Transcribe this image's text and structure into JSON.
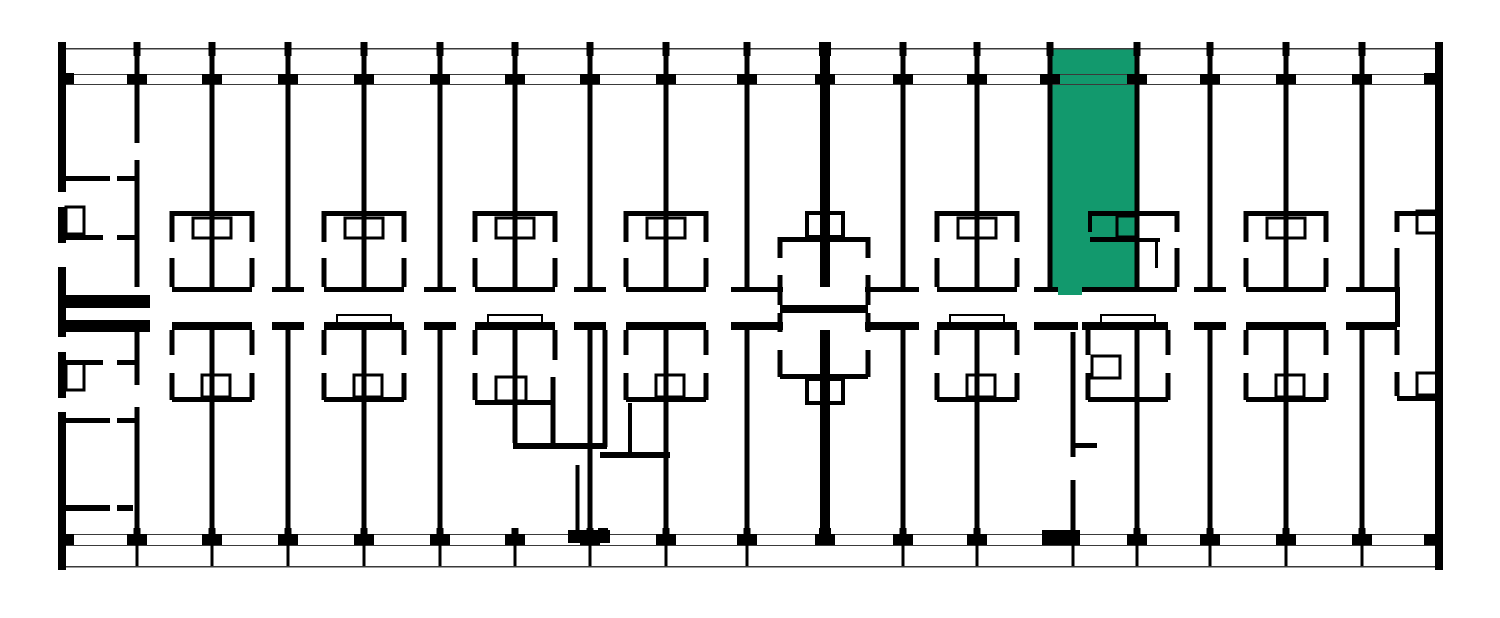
{
  "meta": {
    "view": "building-floor-plan",
    "canvas": {
      "width": 1500,
      "height": 618
    },
    "background": "#ffffff",
    "wall_color": "#000000",
    "thin_line_color": "#3a3a3a",
    "highlight_color": "#12996D"
  },
  "selected_unit": {
    "rects": [
      [
        1050,
        48,
        87,
        240
      ],
      [
        1058,
        286,
        24,
        9
      ]
    ]
  },
  "thin_lines": [
    [
      58,
      48,
      1385,
      1.6
    ],
    [
      58,
      74,
      1385,
      1.2
    ],
    [
      58,
      84,
      1385,
      1.2
    ],
    [
      58,
      534,
      1385,
      1.2
    ],
    [
      58,
      545,
      1385,
      1.2
    ],
    [
      58,
      566,
      1385,
      1.6
    ]
  ],
  "walls": [
    [
      58,
      42,
      8,
      528
    ],
    [
      1435,
      42,
      8,
      528
    ],
    [
      134.5,
      49,
      5,
      94
    ],
    [
      134.5,
      160,
      5,
      127
    ],
    [
      209.5,
      49,
      5,
      238
    ],
    [
      285.5,
      49,
      5,
      238
    ],
    [
      361.5,
      49,
      5,
      238
    ],
    [
      437.5,
      49,
      5,
      238
    ],
    [
      512.5,
      49,
      5,
      238
    ],
    [
      587.5,
      49,
      5,
      238
    ],
    [
      663.5,
      49,
      5,
      238
    ],
    [
      744.5,
      49,
      5,
      238
    ],
    [
      820,
      49,
      10,
      238
    ],
    [
      900.5,
      49,
      5,
      238
    ],
    [
      974.5,
      49,
      5,
      238
    ],
    [
      1047.5,
      49,
      5,
      238
    ],
    [
      1134.5,
      49,
      5,
      238
    ],
    [
      1207.5,
      49,
      5,
      238
    ],
    [
      1283.5,
      49,
      5,
      238
    ],
    [
      1359.5,
      49,
      5,
      238
    ],
    [
      134.5,
      330,
      5,
      55
    ],
    [
      134.5,
      407,
      5,
      138
    ],
    [
      209.5,
      330,
      5,
      215
    ],
    [
      285.5,
      330,
      5,
      215
    ],
    [
      361.5,
      330,
      5,
      215
    ],
    [
      437.5,
      330,
      5,
      215
    ],
    [
      512.5,
      330,
      5,
      113
    ],
    [
      587.5,
      330,
      5,
      215
    ],
    [
      663.5,
      330,
      5,
      215
    ],
    [
      744.5,
      330,
      5,
      215
    ],
    [
      820,
      330,
      10,
      215
    ],
    [
      900.5,
      330,
      5,
      215
    ],
    [
      974.5,
      330,
      5,
      215
    ],
    [
      1070.5,
      332,
      5,
      125
    ],
    [
      1070.5,
      480,
      5,
      55
    ],
    [
      1134.5,
      330,
      5,
      215
    ],
    [
      1207.5,
      330,
      5,
      215
    ],
    [
      1283.5,
      330,
      5,
      215
    ],
    [
      1359.5,
      330,
      5,
      215
    ],
    [
      58,
      295,
      92,
      13
    ],
    [
      172,
      287,
      80,
      5
    ],
    [
      272,
      287,
      32,
      5
    ],
    [
      324,
      287,
      80,
      5
    ],
    [
      424,
      287,
      32,
      5
    ],
    [
      475,
      287,
      80,
      5
    ],
    [
      574,
      287,
      32,
      5
    ],
    [
      626,
      287,
      80,
      5
    ],
    [
      731,
      287,
      52,
      5
    ],
    [
      865,
      287,
      54,
      5
    ],
    [
      937,
      287,
      80,
      5
    ],
    [
      1034,
      287,
      24,
      5
    ],
    [
      1082,
      287,
      95,
      5
    ],
    [
      1194,
      287,
      32,
      5
    ],
    [
      1246,
      287,
      80,
      5
    ],
    [
      1346,
      287,
      51,
      5
    ],
    [
      58,
      320,
      92,
      12
    ],
    [
      172,
      322,
      80,
      8
    ],
    [
      272,
      322,
      32,
      8
    ],
    [
      324,
      322,
      80,
      8
    ],
    [
      424,
      322,
      32,
      8
    ],
    [
      475,
      322,
      80,
      8
    ],
    [
      574,
      322,
      32,
      8
    ],
    [
      626,
      322,
      80,
      8
    ],
    [
      731,
      322,
      52,
      8
    ],
    [
      865,
      322,
      54,
      8
    ],
    [
      937,
      322,
      80,
      8
    ],
    [
      1034,
      322,
      44,
      8
    ],
    [
      1082,
      322,
      86,
      8
    ],
    [
      1194,
      322,
      32,
      8
    ],
    [
      1246,
      322,
      80,
      8
    ],
    [
      1346,
      322,
      51,
      8
    ],
    [
      1395,
      287,
      5,
      40
    ],
    [
      172,
      211,
      80,
      5
    ],
    [
      169.5,
      211,
      5,
      31
    ],
    [
      169.5,
      258,
      5,
      29
    ],
    [
      249.5,
      211,
      5,
      31
    ],
    [
      249.5,
      258,
      5,
      29
    ],
    [
      324,
      211,
      80,
      5
    ],
    [
      321.5,
      211,
      5,
      31
    ],
    [
      321.5,
      258,
      5,
      29
    ],
    [
      401.5,
      211,
      5,
      31
    ],
    [
      401.5,
      258,
      5,
      29
    ],
    [
      475,
      211,
      80,
      5
    ],
    [
      472.5,
      211,
      5,
      31
    ],
    [
      472.5,
      258,
      5,
      29
    ],
    [
      552.5,
      211,
      5,
      31
    ],
    [
      552.5,
      258,
      5,
      29
    ],
    [
      626,
      211,
      80,
      5
    ],
    [
      623.5,
      211,
      5,
      31
    ],
    [
      623.5,
      258,
      5,
      29
    ],
    [
      703.5,
      211,
      5,
      31
    ],
    [
      703.5,
      258,
      5,
      29
    ],
    [
      937,
      211,
      80,
      5
    ],
    [
      934.5,
      211,
      5,
      31
    ],
    [
      934.5,
      258,
      5,
      29
    ],
    [
      1014.5,
      211,
      5,
      31
    ],
    [
      1014.5,
      258,
      5,
      29
    ],
    [
      1246,
      211,
      80,
      5
    ],
    [
      1243.5,
      211,
      5,
      31
    ],
    [
      1243.5,
      258,
      5,
      29
    ],
    [
      1323.5,
      211,
      5,
      31
    ],
    [
      1323.5,
      258,
      5,
      29
    ],
    [
      1088,
      211,
      49,
      5
    ],
    [
      1137,
      211,
      40,
      5
    ],
    [
      1088,
      216,
      4,
      16
    ],
    [
      1090,
      237,
      47,
      5
    ],
    [
      1174.5,
      211,
      5,
      21
    ],
    [
      1174.5,
      248,
      5,
      39
    ],
    [
      1137,
      238,
      23,
      4
    ],
    [
      1155,
      238,
      3,
      30
    ],
    [
      1397,
      211,
      43,
      5
    ],
    [
      1394.5,
      211,
      5,
      21
    ],
    [
      1394.5,
      248,
      5,
      39
    ],
    [
      1397,
      396,
      43,
      5
    ],
    [
      1394.5,
      330,
      5,
      25
    ],
    [
      1394.5,
      372,
      5,
      24
    ],
    [
      169.5,
      330,
      5,
      25
    ],
    [
      169.5,
      373,
      5,
      27
    ],
    [
      249.5,
      330,
      5,
      25
    ],
    [
      249.5,
      373,
      5,
      27
    ],
    [
      172,
      397,
      80,
      5
    ],
    [
      321.5,
      330,
      5,
      25
    ],
    [
      321.5,
      373,
      5,
      27
    ],
    [
      401.5,
      330,
      5,
      25
    ],
    [
      401.5,
      373,
      5,
      27
    ],
    [
      324,
      397,
      80,
      5
    ],
    [
      623.5,
      330,
      5,
      25
    ],
    [
      623.5,
      373,
      5,
      27
    ],
    [
      703.5,
      330,
      5,
      25
    ],
    [
      703.5,
      373,
      5,
      27
    ],
    [
      626,
      397,
      80,
      5
    ],
    [
      934.5,
      330,
      5,
      25
    ],
    [
      934.5,
      373,
      5,
      27
    ],
    [
      1014.5,
      330,
      5,
      25
    ],
    [
      1014.5,
      373,
      5,
      27
    ],
    [
      937,
      397,
      80,
      5
    ],
    [
      1243.5,
      330,
      5,
      25
    ],
    [
      1243.5,
      373,
      5,
      27
    ],
    [
      1323.5,
      330,
      5,
      25
    ],
    [
      1323.5,
      373,
      5,
      27
    ],
    [
      1246,
      397,
      80,
      5
    ],
    [
      472.5,
      330,
      5,
      25
    ],
    [
      472.5,
      373,
      5,
      27
    ],
    [
      552.5,
      330,
      5,
      30
    ],
    [
      475,
      400,
      80,
      5
    ],
    [
      513,
      443,
      94,
      6
    ],
    [
      550.5,
      377,
      5,
      66
    ],
    [
      602.5,
      330,
      5,
      117
    ],
    [
      575.5,
      465,
      4,
      70
    ],
    [
      628,
      403,
      4,
      49
    ],
    [
      600,
      452,
      70,
      6
    ],
    [
      1085.5,
      330,
      5,
      25
    ],
    [
      1085.5,
      373,
      5,
      27
    ],
    [
      1165.5,
      330,
      5,
      25
    ],
    [
      1165.5,
      373,
      5,
      27
    ],
    [
      1088,
      397,
      80,
      5
    ],
    [
      1073,
      443,
      24,
      5
    ],
    [
      780,
      237,
      88,
      5
    ],
    [
      777.5,
      237,
      5,
      21
    ],
    [
      777.5,
      275,
      5,
      30
    ],
    [
      865.5,
      237,
      5,
      21
    ],
    [
      865.5,
      275,
      5,
      30
    ],
    [
      780,
      305,
      88,
      8
    ],
    [
      777.5,
      313,
      5,
      19
    ],
    [
      777.5,
      350,
      5,
      27
    ],
    [
      865.5,
      313,
      5,
      19
    ],
    [
      865.5,
      350,
      5,
      27
    ],
    [
      780,
      374,
      88,
      5
    ],
    [
      58,
      176,
      52,
      5
    ],
    [
      117,
      176,
      20,
      5
    ],
    [
      58,
      235,
      45,
      5
    ],
    [
      117,
      235,
      20,
      5
    ],
    [
      58,
      360,
      45,
      5
    ],
    [
      117,
      360,
      20,
      5
    ],
    [
      58,
      418,
      52,
      5
    ],
    [
      117,
      418,
      20,
      5
    ],
    [
      58,
      505,
      52,
      6
    ],
    [
      117,
      505,
      16,
      6
    ]
  ],
  "blocks": [
    [
      133.5,
      42,
      7,
      14
    ],
    [
      208.5,
      42,
      7,
      14
    ],
    [
      284.5,
      42,
      7,
      14
    ],
    [
      360.5,
      42,
      7,
      14
    ],
    [
      436.5,
      42,
      7,
      14
    ],
    [
      511.5,
      42,
      7,
      14
    ],
    [
      586.5,
      42,
      7,
      14
    ],
    [
      662.5,
      42,
      7,
      14
    ],
    [
      743.5,
      42,
      7,
      14
    ],
    [
      819,
      42,
      12,
      14
    ],
    [
      899.5,
      42,
      7,
      14
    ],
    [
      973.5,
      42,
      7,
      14
    ],
    [
      1046.5,
      42,
      7,
      14
    ],
    [
      1133.5,
      42,
      7,
      14
    ],
    [
      1206.5,
      42,
      7,
      14
    ],
    [
      1282.5,
      42,
      7,
      14
    ],
    [
      1358.5,
      42,
      7,
      14
    ],
    [
      135.5,
      48,
      3,
      26
    ],
    [
      210.5,
      48,
      3,
      26
    ],
    [
      286.5,
      48,
      3,
      26
    ],
    [
      362.5,
      48,
      3,
      26
    ],
    [
      438.5,
      48,
      3,
      26
    ],
    [
      513.5,
      48,
      3,
      26
    ],
    [
      588.5,
      48,
      3,
      26
    ],
    [
      664.5,
      48,
      3,
      26
    ],
    [
      745.5,
      48,
      3,
      26
    ],
    [
      901.5,
      48,
      3,
      26
    ],
    [
      975.5,
      48,
      3,
      26
    ],
    [
      1048.5,
      48,
      3,
      26
    ],
    [
      1135.5,
      48,
      3,
      26
    ],
    [
      1208.5,
      48,
      3,
      26
    ],
    [
      1284.5,
      48,
      3,
      26
    ],
    [
      1360.5,
      48,
      3,
      26
    ],
    [
      127,
      74,
      20,
      10
    ],
    [
      202,
      74,
      20,
      10
    ],
    [
      278,
      74,
      20,
      10
    ],
    [
      354,
      74,
      20,
      10
    ],
    [
      430,
      74,
      20,
      10
    ],
    [
      505,
      74,
      20,
      10
    ],
    [
      580,
      74,
      20,
      10
    ],
    [
      656,
      74,
      20,
      10
    ],
    [
      737,
      74,
      20,
      10
    ],
    [
      815,
      74,
      20,
      10
    ],
    [
      893,
      74,
      20,
      10
    ],
    [
      967,
      74,
      20,
      10
    ],
    [
      1040,
      74,
      20,
      10
    ],
    [
      1127,
      74,
      20,
      10
    ],
    [
      1200,
      74,
      20,
      10
    ],
    [
      1276,
      74,
      20,
      10
    ],
    [
      1352,
      74,
      20,
      10
    ],
    [
      58,
      73,
      16,
      11
    ],
    [
      1424,
      73,
      16,
      11
    ],
    [
      58,
      534,
      16,
      11
    ],
    [
      1424,
      534,
      16,
      11
    ],
    [
      127,
      534,
      20,
      11
    ],
    [
      202,
      534,
      20,
      11
    ],
    [
      278,
      534,
      20,
      11
    ],
    [
      354,
      534,
      20,
      11
    ],
    [
      430,
      534,
      20,
      11
    ],
    [
      505,
      534,
      20,
      11
    ],
    [
      580,
      534,
      20,
      11
    ],
    [
      656,
      534,
      20,
      11
    ],
    [
      737,
      534,
      20,
      11
    ],
    [
      815,
      534,
      20,
      11
    ],
    [
      893,
      534,
      20,
      11
    ],
    [
      967,
      534,
      20,
      11
    ],
    [
      1127,
      534,
      20,
      11
    ],
    [
      1200,
      534,
      20,
      11
    ],
    [
      1276,
      534,
      20,
      11
    ],
    [
      1352,
      534,
      20,
      11
    ],
    [
      135.5,
      545,
      3,
      21
    ],
    [
      210.5,
      545,
      3,
      21
    ],
    [
      286.5,
      545,
      3,
      21
    ],
    [
      362.5,
      545,
      3,
      21
    ],
    [
      438.5,
      545,
      3,
      21
    ],
    [
      513.5,
      545,
      3,
      21
    ],
    [
      588.5,
      545,
      3,
      21
    ],
    [
      664.5,
      545,
      3,
      21
    ],
    [
      745.5,
      545,
      3,
      21
    ],
    [
      901.5,
      545,
      3,
      21
    ],
    [
      975.5,
      545,
      3,
      21
    ],
    [
      1071.5,
      545,
      3,
      21
    ],
    [
      1135.5,
      545,
      3,
      21
    ],
    [
      1208.5,
      545,
      3,
      21
    ],
    [
      1284.5,
      545,
      3,
      21
    ],
    [
      1360.5,
      545,
      3,
      21
    ],
    [
      133.5,
      528,
      7,
      17
    ],
    [
      208.5,
      528,
      7,
      17
    ],
    [
      284.5,
      528,
      7,
      17
    ],
    [
      360.5,
      528,
      7,
      17
    ],
    [
      436.5,
      528,
      7,
      17
    ],
    [
      511.5,
      528,
      7,
      17
    ],
    [
      586.5,
      528,
      7,
      17
    ],
    [
      662.5,
      528,
      7,
      17
    ],
    [
      743.5,
      528,
      7,
      17
    ],
    [
      819,
      528,
      12,
      17
    ],
    [
      899.5,
      528,
      7,
      17
    ],
    [
      973.5,
      528,
      7,
      17
    ],
    [
      1133.5,
      528,
      7,
      17
    ],
    [
      1206.5,
      528,
      7,
      17
    ],
    [
      1282.5,
      528,
      7,
      17
    ],
    [
      1358.5,
      528,
      7,
      17
    ],
    [
      568,
      530,
      42,
      13
    ],
    [
      598,
      528,
      10,
      15
    ],
    [
      1042,
      530,
      38,
      15
    ]
  ],
  "windows": [
    [
      58,
      192,
      8,
      15
    ],
    [
      58,
      243,
      8,
      24
    ],
    [
      58,
      337,
      8,
      15
    ],
    [
      58,
      398,
      8,
      14
    ]
  ],
  "fixture_outlines": [
    [
      193,
      218,
      38,
      20,
      3
    ],
    [
      345,
      218,
      38,
      20,
      3
    ],
    [
      496,
      218,
      38,
      20,
      3
    ],
    [
      647,
      218,
      38,
      20,
      3
    ],
    [
      958,
      218,
      38,
      20,
      3
    ],
    [
      1267,
      218,
      38,
      20,
      3
    ],
    [
      1117,
      216,
      20,
      21,
      3
    ],
    [
      1417,
      211,
      20,
      22,
      3
    ],
    [
      1417,
      373,
      20,
      22,
      3
    ],
    [
      202,
      375,
      28,
      22,
      3
    ],
    [
      354,
      375,
      28,
      22,
      3
    ],
    [
      656,
      375,
      28,
      22,
      3
    ],
    [
      967,
      375,
      28,
      22,
      3
    ],
    [
      1276,
      375,
      28,
      22,
      3
    ],
    [
      496,
      377,
      30,
      24,
      3
    ],
    [
      1092,
      356,
      28,
      22,
      3
    ],
    [
      337,
      315,
      54,
      8,
      2
    ],
    [
      950,
      315,
      54,
      8,
      2
    ],
    [
      488,
      315,
      54,
      8,
      2
    ],
    [
      1101,
      315,
      54,
      8,
      2
    ],
    [
      807,
      213,
      36,
      24,
      4
    ],
    [
      807,
      379,
      36,
      24,
      4
    ],
    [
      66,
      207,
      18,
      27,
      3
    ],
    [
      66,
      363,
      18,
      27,
      3
    ]
  ]
}
